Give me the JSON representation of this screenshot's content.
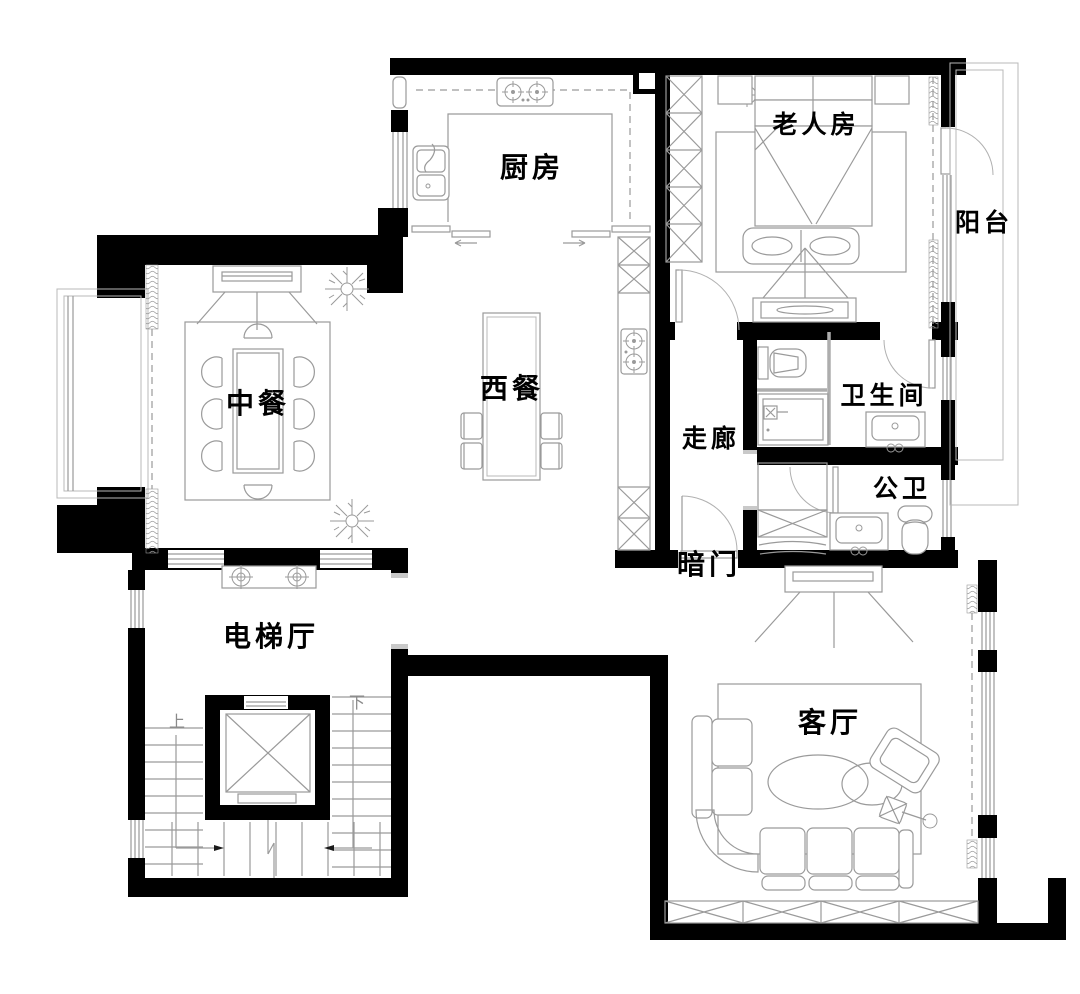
{
  "plan": {
    "type": "residential floor plan",
    "colors": {
      "wall": "#000000",
      "furniture_line": "#9a9a9a",
      "label": "#000000",
      "background": "#ffffff"
    },
    "rooms": {
      "kitchen": "厨房",
      "elder_room": "老人房",
      "balcony": "阳台",
      "chinese_dining": "中餐",
      "western_dining": "西餐",
      "corridor": "走廊",
      "bathroom": "卫生间",
      "public_bathroom": "公卫",
      "hidden_door": "暗门",
      "elevator_hall": "电梯厅",
      "living_room": "客厅"
    },
    "stairs": {
      "up": "上",
      "down": "下"
    }
  }
}
